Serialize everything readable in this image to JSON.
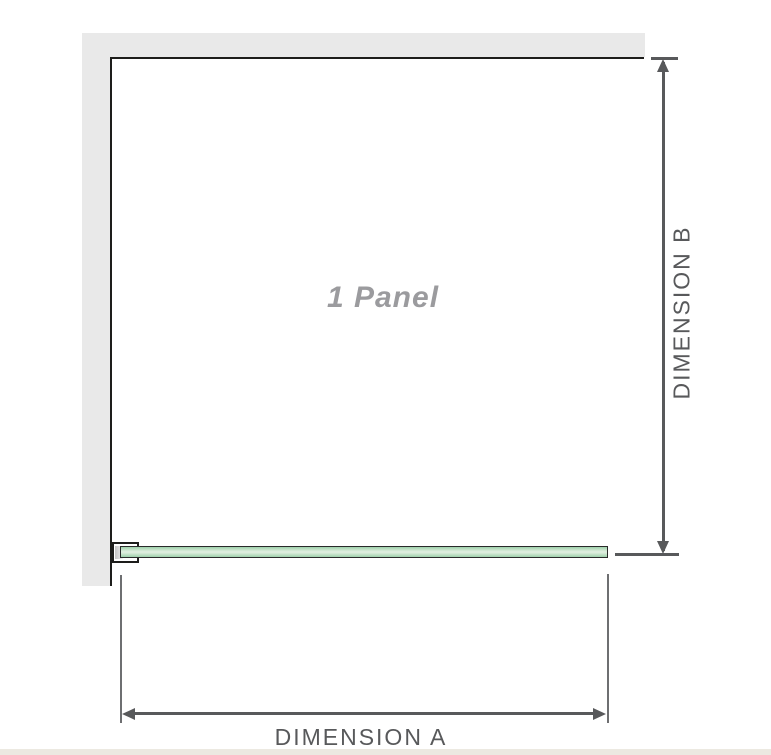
{
  "diagram": {
    "panel_label": "1 Panel",
    "dimension_a_label": "DIMENSION A",
    "dimension_b_label": "DIMENSION B"
  },
  "colors": {
    "wall_gray": "#e9e9e9",
    "outline_black": "#1d1d1b",
    "dim_line": "#58595b",
    "ext_line": "#6e6f71",
    "label_gray": "#9b9b9e",
    "glass_green": "#9ed1ab",
    "glass_green_light": "#deeede",
    "glass_border": "#2a2a2a",
    "footer_beige": "#ece9e1"
  }
}
